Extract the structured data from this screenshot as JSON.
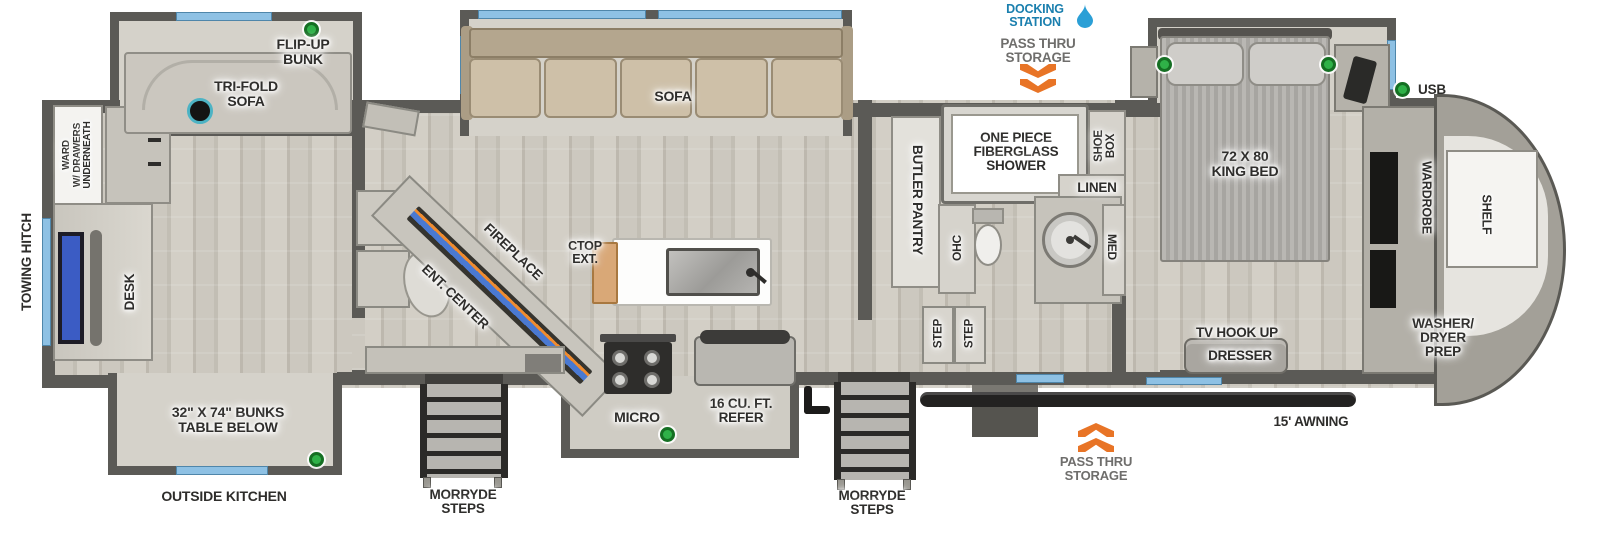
{
  "title": "Fifth wheel RV floorplan",
  "colors": {
    "accent_green": "#2fb148",
    "window_blue": "#8ec1e4",
    "docking_blue": "#1a7fae",
    "chevron_orange": "#e87426",
    "awning_black": "#232221",
    "wall_gray": "#5b5a56"
  },
  "labels": {
    "towing_hitch": "TOWING HITCH",
    "ward": "WARD\nW/ DRAWERS\nUNDERNEATH",
    "desk": "DESK",
    "tri_fold_sofa": "TRI-FOLD\nSOFA",
    "flip_up_bunk": "FLIP-UP\nBUNK",
    "bunks": "32\" X 74\" BUNKS\nTABLE BELOW",
    "outside_kitchen": "OUTSIDE KITCHEN",
    "sofa": "SOFA",
    "ent_center": "ENT. CENTER",
    "fireplace": "FIREPLACE",
    "ctop_ext": "CTOP\nEXT.",
    "micro": "MICRO",
    "refer": "16 CU. FT.\nREFER",
    "morryde_steps_left": "MORRYDE\nSTEPS",
    "morryde_steps_right": "MORRYDE\nSTEPS",
    "butler_pantry": "BUTLER PANTRY",
    "shower": "ONE PIECE\nFIBERGLASS\nSHOWER",
    "shoe_box": "SHOE\nBOX",
    "linen": "LINEN",
    "ohc": "OHC",
    "med": "MED",
    "step_1": "STEP",
    "step_2": "STEP",
    "docking_station": "DOCKING\nSTATION",
    "pass_thru_top": "PASS THRU\nSTORAGE",
    "pass_thru_bottom": "PASS THRU\nSTORAGE",
    "king_bed": "72 X 80\nKING BED",
    "usb": "USB",
    "wardrobe": "WARDROBE",
    "shelf": "SHELF",
    "washer_dryer": "WASHER/\nDRYER\nPREP",
    "tv_hook_up": "TV HOOK UP",
    "dresser": "DRESSER",
    "awning": "15' AWNING"
  }
}
